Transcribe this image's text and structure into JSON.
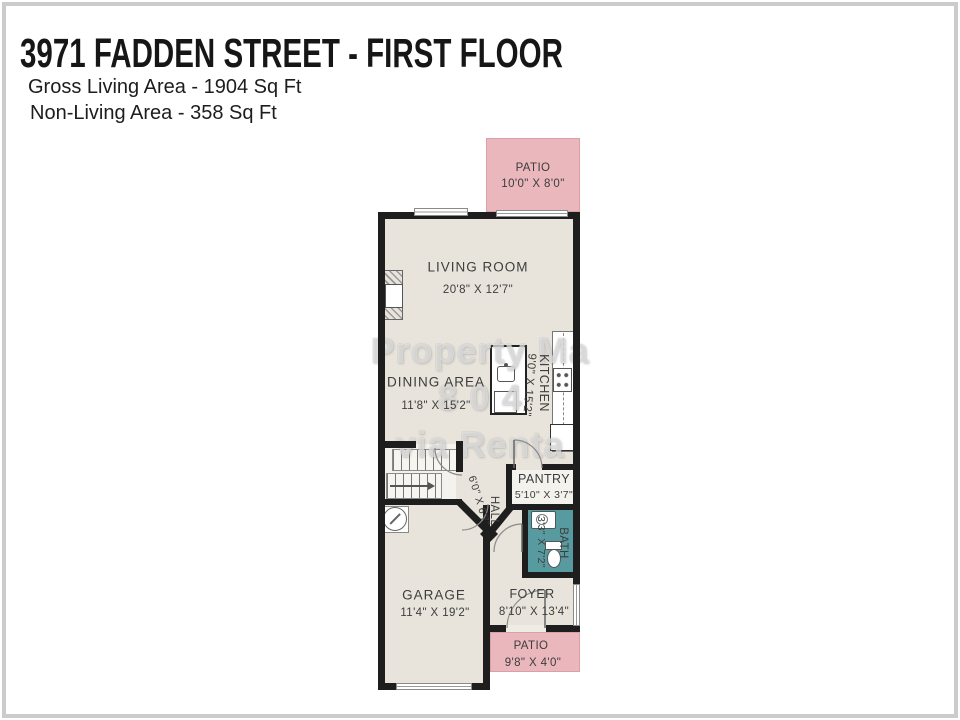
{
  "header": {
    "title": "3971 FADDEN STREET - FIRST FLOOR",
    "gross": "Gross Living Area - 1904 Sq Ft",
    "nonliving": "Non-Living Area - 358 Sq Ft"
  },
  "plan": {
    "patio_top": {
      "name": "PATIO",
      "dims": "10'0\" X 8'0\""
    },
    "living_room": {
      "name": "LIVING ROOM",
      "dims": "20'8\" X 12'7\""
    },
    "dining_area": {
      "name": "DINING AREA",
      "dims": "11'8\" X 15'2\""
    },
    "kitchen": {
      "name": "KITCHEN",
      "dims": "9'0\" X 15'2\""
    },
    "pantry": {
      "name": "PANTRY",
      "dims": "5'10\" X 3'7\""
    },
    "hall": {
      "name": "HALL",
      "dims": "6'0\" X 6'7\""
    },
    "bath": {
      "name": "BATH",
      "dims": "3'3\" X 7'2\""
    },
    "garage": {
      "name": "GARAGE",
      "dims": "11'4\" X 19'2\""
    },
    "foyer": {
      "name": "FOYER",
      "dims": "8'10\" X 13'4\""
    },
    "patio_bottom": {
      "name": "PATIO",
      "dims": "9'8\" X 4'0\""
    }
  },
  "watermark": {
    "line1": "Property Ma",
    "line2": "8 0 4",
    "line3": "via Renta"
  },
  "colors": {
    "wall": "#1e1e1e",
    "floor": "#e8e4db",
    "patio": "#eab7bd",
    "bath": "#579ba1",
    "label_text": "#3d3d3d",
    "frame": "#cbcbcb"
  }
}
